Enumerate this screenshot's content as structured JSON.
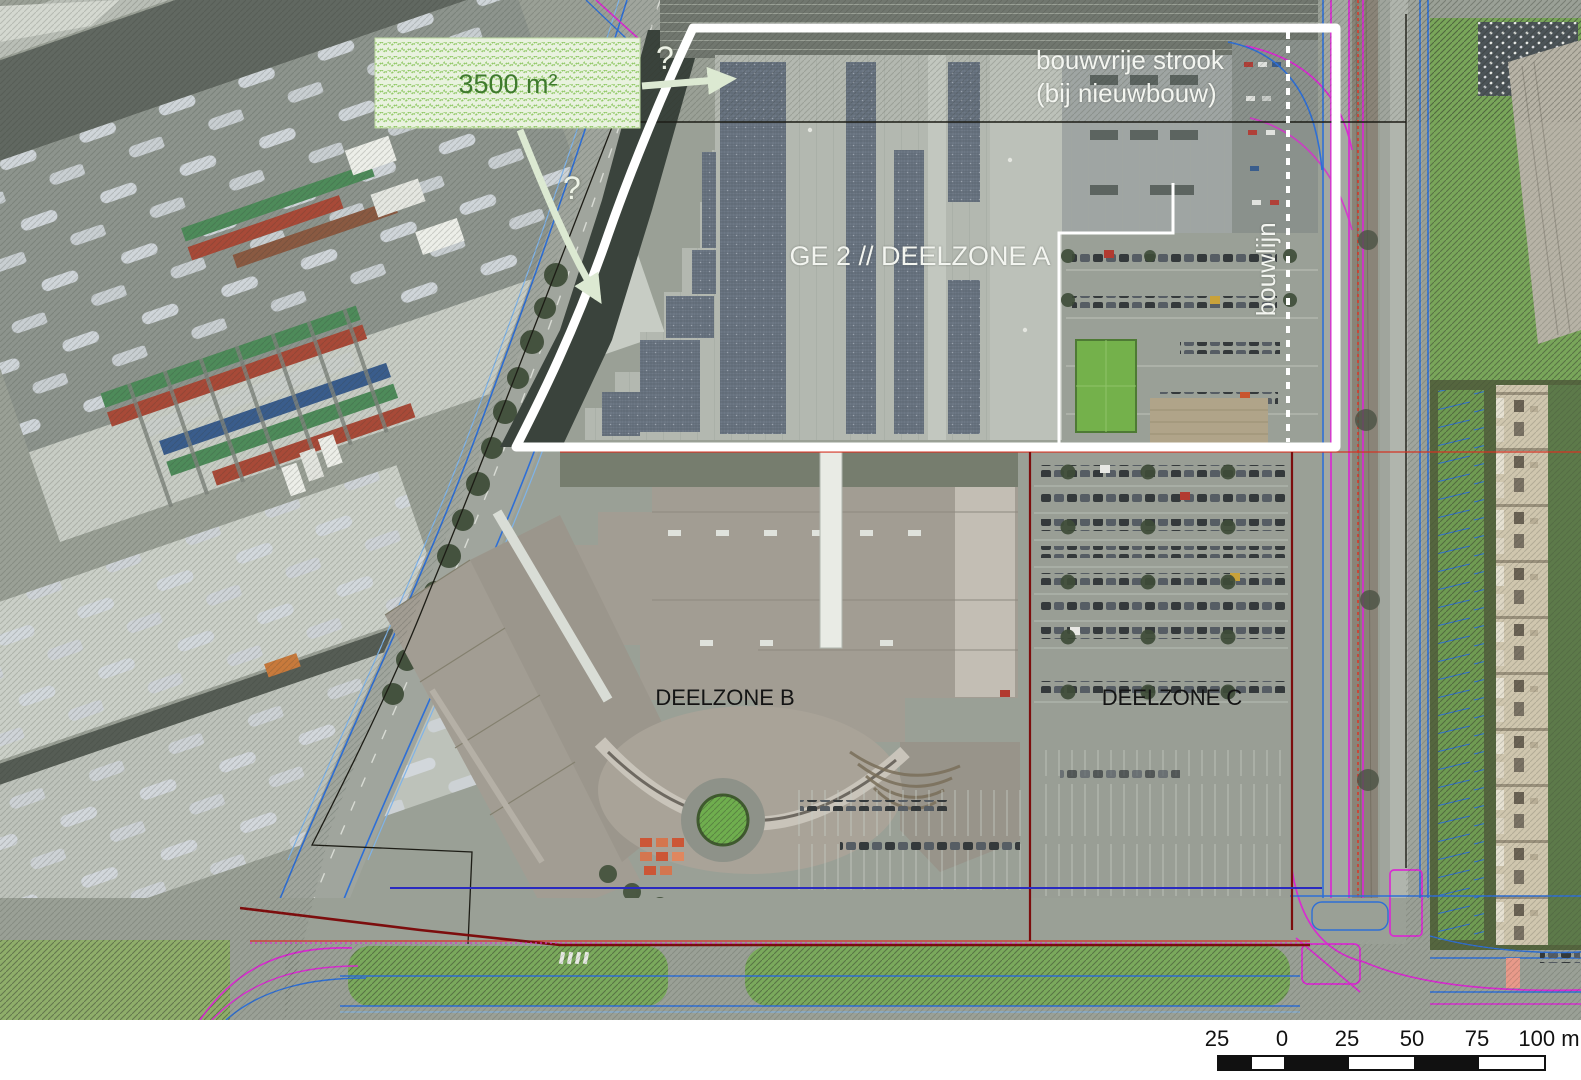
{
  "annotations": {
    "area_box": {
      "label": "3500 m²"
    },
    "question_mark_1": "?",
    "question_mark_2": "?",
    "bouwvrije_strook": {
      "line1": "bouwvrije strook",
      "line2": "(bij nieuwbouw)"
    },
    "zone_a": {
      "label": "GE 2 // DEELZONE A"
    },
    "zone_b": {
      "label": "DEELZONE B"
    },
    "zone_c": {
      "label": "DEELZONE C"
    },
    "bouwlijn": {
      "label": "bouwlijn"
    }
  },
  "scale_bar": {
    "labels": [
      "25",
      "0",
      "25",
      "50",
      "75",
      "100 m"
    ]
  },
  "colors": {
    "zone_boundary": "#ffffff",
    "bouwlijn_line": "#ffffff",
    "arrow_green": "#dce9d2",
    "area_box_text": "#3f7a2e",
    "area_box_bg": "#e9f2df",
    "area_box_pattern": "#92c968",
    "overlay_blue": "#2e6fd6",
    "overlay_cyan": "#7fb3e8",
    "overlay_magenta": "#d82cd0",
    "overlay_red": "#d43424",
    "overlay_maroon": "#7c0d0d",
    "overlay_navy": "#2a2ac0",
    "plan_boundary": "#1d1d16"
  }
}
